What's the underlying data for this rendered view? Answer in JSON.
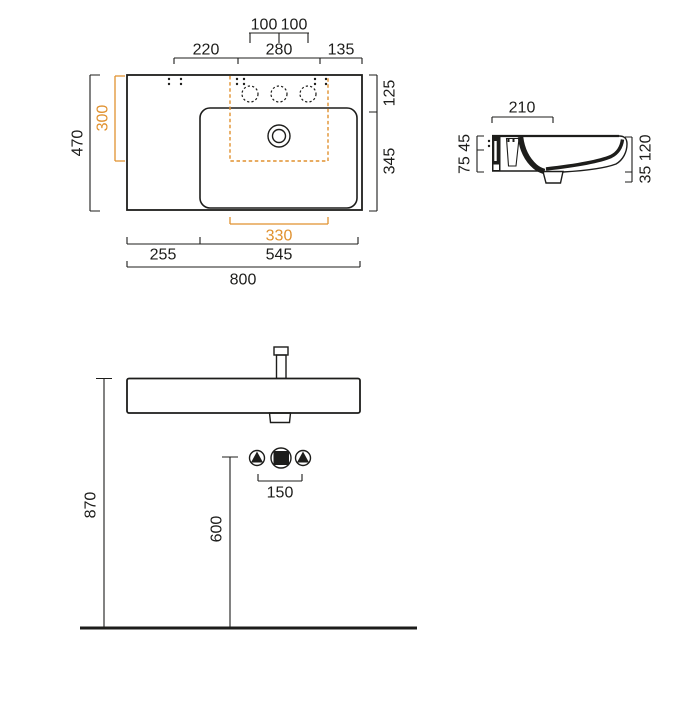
{
  "colors": {
    "line": "#1d1d1b",
    "accent": "#e0912f"
  },
  "top_view": {
    "hole_pitch_left": "100",
    "hole_pitch_right": "100",
    "deck_left": "220",
    "deck_center": "280",
    "deck_right": "135",
    "depth_right_back": "125",
    "depth_right_front": "345",
    "depth_total": "470",
    "bowl_depth": "300",
    "bowl_width": "330",
    "bottom_left": "255",
    "bottom_right": "545",
    "width_total": "800"
  },
  "side_view": {
    "deck_depth": "210",
    "left_heights": "75 45",
    "right_heights": "35 120"
  },
  "front_view": {
    "rim_height": "870",
    "outlet_height": "600",
    "connection_pitch": "150"
  }
}
